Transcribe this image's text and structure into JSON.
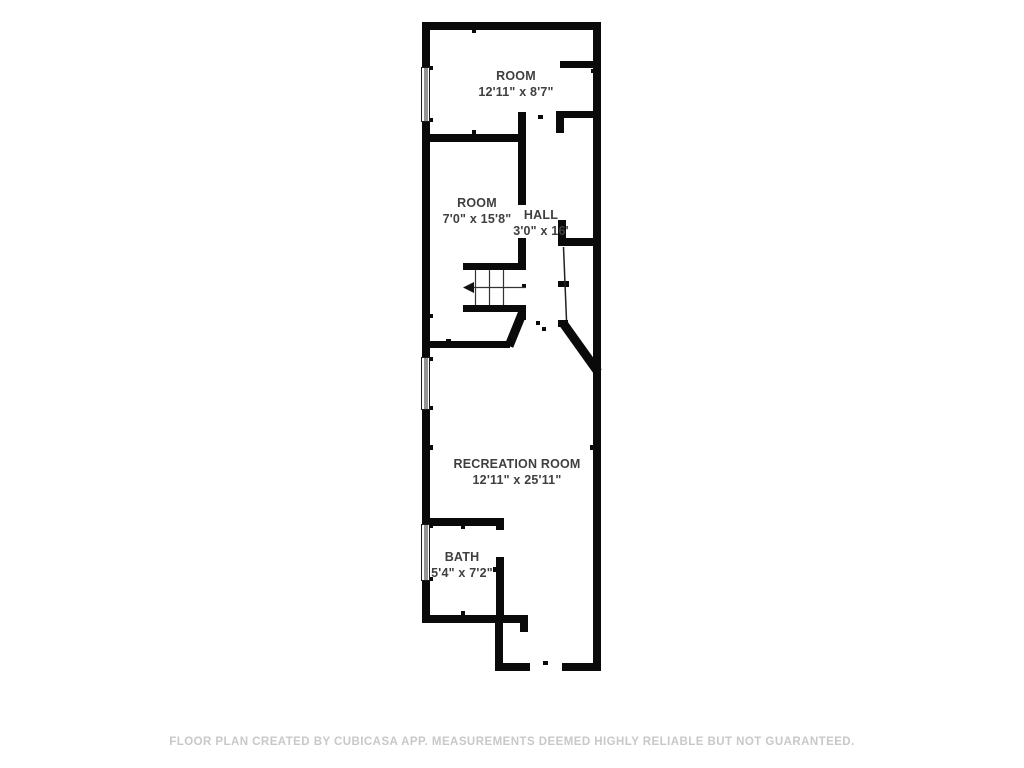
{
  "page": {
    "background": "#ffffff"
  },
  "floor_plan": {
    "rooms": [
      {
        "name": "ROOM",
        "dimensions": "12'11\" x 8'7\""
      },
      {
        "name": "ROOM",
        "dimensions": "7'0\" x 15'8\""
      },
      {
        "name": "HALL",
        "dimensions": "3'0\" x 16'"
      },
      {
        "name": "RECREATION ROOM",
        "dimensions": "12'11\" x 25'11\""
      },
      {
        "name": "BATH",
        "dimensions": "5'4\" x 7'2\""
      }
    ],
    "icons": {
      "stair_direction": "left-arrow"
    },
    "colors": {
      "wall": "#0a0a0a",
      "label": "#3f3f3f",
      "disclaimer": "#c8c8c8"
    }
  },
  "footer": {
    "disclaimer": "FLOOR PLAN CREATED BY CUBICASA APP. MEASUREMENTS DEEMED HIGHLY RELIABLE BUT NOT GUARANTEED."
  }
}
